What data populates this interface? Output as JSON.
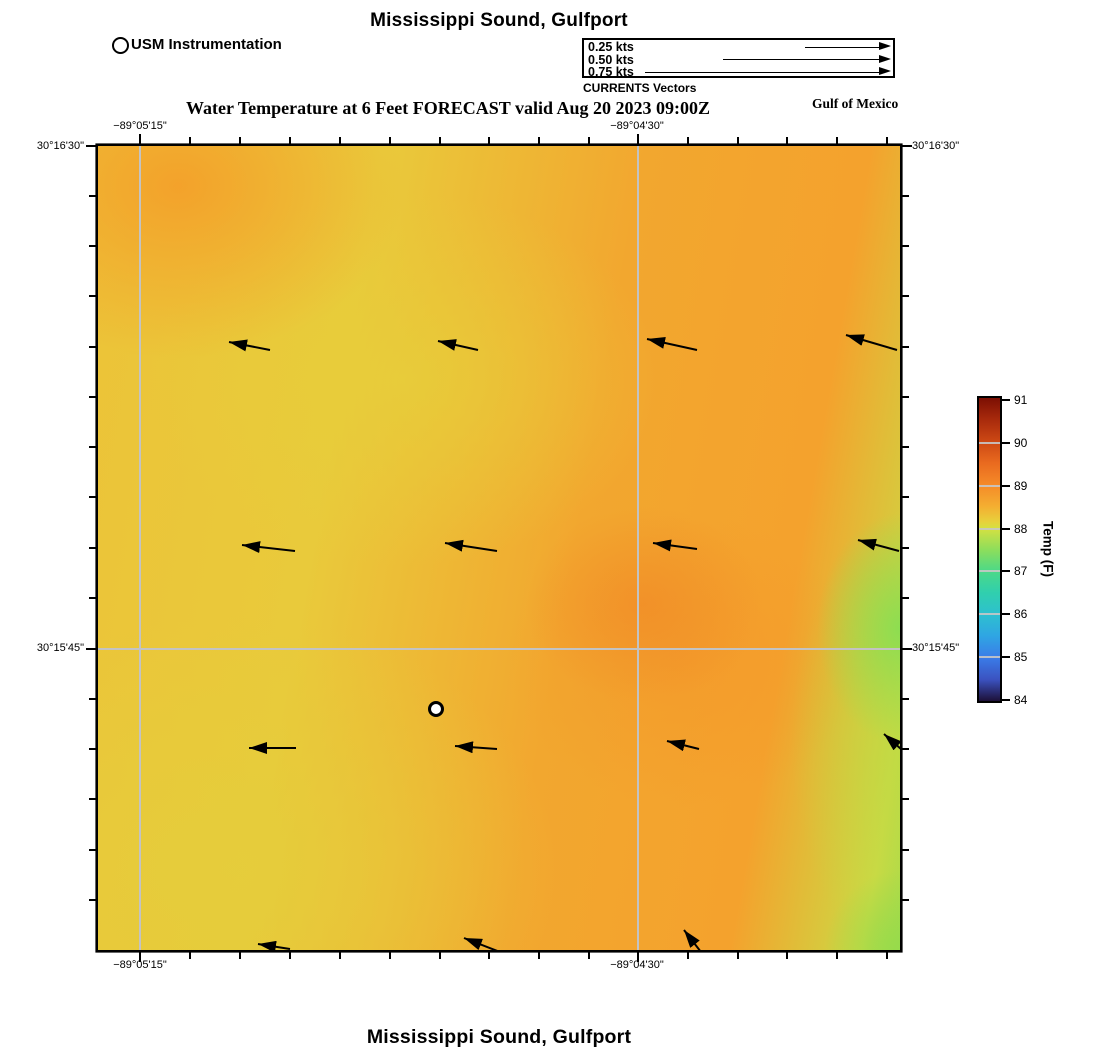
{
  "titles": {
    "top": "Mississippi Sound, Gulfport",
    "subtitle": "Water Temperature at 6 Feet FORECAST valid Aug 20 2023 09:00Z",
    "bottom": "Mississippi Sound, Gulfport",
    "region": "Gulf of Mexico"
  },
  "station_legend": {
    "label": "USM Instrumentation"
  },
  "currents_legend": {
    "caption": "CURRENTS Vectors",
    "items": [
      {
        "label": "0.25 kts",
        "arrow_px": 88
      },
      {
        "label": "0.50 kts",
        "arrow_px": 170
      },
      {
        "label": "0.75 kts",
        "arrow_px": 248
      }
    ]
  },
  "axes": {
    "x_labels": [
      {
        "text": "−89°05'15\"",
        "px": 140
      },
      {
        "text": "−89°04'30\"",
        "px": 637
      }
    ],
    "y_labels": [
      {
        "text": "30°16'30\"",
        "px": 147
      },
      {
        "text": "30°15'45\"",
        "px": 649
      }
    ]
  },
  "colorbar": {
    "label": "Temp (F)",
    "min": 84,
    "max": 91,
    "ticks": [
      91,
      90,
      89,
      88,
      87,
      86,
      85,
      84
    ],
    "stops": [
      {
        "v": 91.0,
        "c": "#7c0f03"
      },
      {
        "v": 90.5,
        "c": "#a82a0c"
      },
      {
        "v": 90.0,
        "c": "#cc4814"
      },
      {
        "v": 89.5,
        "c": "#e96a1f"
      },
      {
        "v": 89.0,
        "c": "#f58a28"
      },
      {
        "v": 88.5,
        "c": "#f4ae31"
      },
      {
        "v": 88.15,
        "c": "#e8d03c"
      },
      {
        "v": 88.0,
        "c": "#d6e041"
      },
      {
        "v": 87.5,
        "c": "#8ede5b"
      },
      {
        "v": 87.0,
        "c": "#4cd987"
      },
      {
        "v": 86.5,
        "c": "#30cfae"
      },
      {
        "v": 86.0,
        "c": "#2ec0cf"
      },
      {
        "v": 85.5,
        "c": "#2fa5e3"
      },
      {
        "v": 85.0,
        "c": "#3a7ce8"
      },
      {
        "v": 84.5,
        "c": "#3b52c0"
      },
      {
        "v": 84.0,
        "c": "#1d1038"
      }
    ]
  },
  "colors": {
    "map_border": "#000000",
    "gridline": "#c3c3c3",
    "arrow": "#000000",
    "field_orange": "#f4a22d",
    "field_yellow": "#e8cd3b",
    "field_dark_orange": "#f18d2a",
    "field_green": "#9edc4e"
  },
  "chart_data": {
    "type": "heatmap",
    "title": "Mississippi Sound, Gulfport",
    "subtitle": "Water Temperature at 6 Feet FORECAST valid Aug 20 2023 09:00Z",
    "field": "Water temperature at 6 feet (F), forecast",
    "valid_time": "Aug 20 2023 09:00Z",
    "region_label": "Gulf of Mexico",
    "x_axis": {
      "type": "longitude",
      "tick_labels": [
        "−89°05'15\"",
        "−89°04'30\""
      ]
    },
    "y_axis": {
      "type": "latitude",
      "tick_labels": [
        "30°16'30\"",
        "30°15'45\""
      ]
    },
    "colorbar": {
      "label": "Temp (F)",
      "min": 84,
      "max": 91,
      "ticks": [
        91,
        90,
        89,
        88,
        87,
        86,
        85,
        84
      ]
    },
    "temp_estimates_F": {
      "top_left_corner": 88.6,
      "upper_mid_left_yellow": 88.2,
      "upper_right_orange": 88.7,
      "center_orange_blob": 88.9,
      "right_edge_mid_green": 87.8,
      "bottom_right_green": 87.8,
      "bottom_left_yellow": 88.2,
      "bottom_mid_orange": 88.6
    },
    "station": {
      "name": "USM Instrumentation",
      "px": [
        338,
        563
      ]
    },
    "current_vectors": {
      "direction": "westward, heads point left / up-left",
      "approx_speed_kts": 0.15,
      "arrows_px": [
        {
          "x1": 131,
          "y1": 196,
          "x2": 172,
          "y2": 204
        },
        {
          "x1": 340,
          "y1": 195,
          "x2": 380,
          "y2": 204
        },
        {
          "x1": 549,
          "y1": 193,
          "x2": 599,
          "y2": 204
        },
        {
          "x1": 748,
          "y1": 189,
          "x2": 799,
          "y2": 204
        },
        {
          "x1": 144,
          "y1": 399,
          "x2": 197,
          "y2": 405
        },
        {
          "x1": 347,
          "y1": 397,
          "x2": 399,
          "y2": 405
        },
        {
          "x1": 555,
          "y1": 397,
          "x2": 599,
          "y2": 403
        },
        {
          "x1": 760,
          "y1": 394,
          "x2": 801,
          "y2": 405
        },
        {
          "x1": 151,
          "y1": 602,
          "x2": 198,
          "y2": 602
        },
        {
          "x1": 357,
          "y1": 600,
          "x2": 399,
          "y2": 603
        },
        {
          "x1": 569,
          "y1": 595,
          "x2": 601,
          "y2": 603
        },
        {
          "x1": 786,
          "y1": 588,
          "x2": 803,
          "y2": 603
        },
        {
          "x1": 160,
          "y1": 798,
          "x2": 192,
          "y2": 803
        },
        {
          "x1": 366,
          "y1": 792,
          "x2": 402,
          "y2": 806
        },
        {
          "x1": 586,
          "y1": 784,
          "x2": 603,
          "y2": 806
        }
      ]
    }
  }
}
